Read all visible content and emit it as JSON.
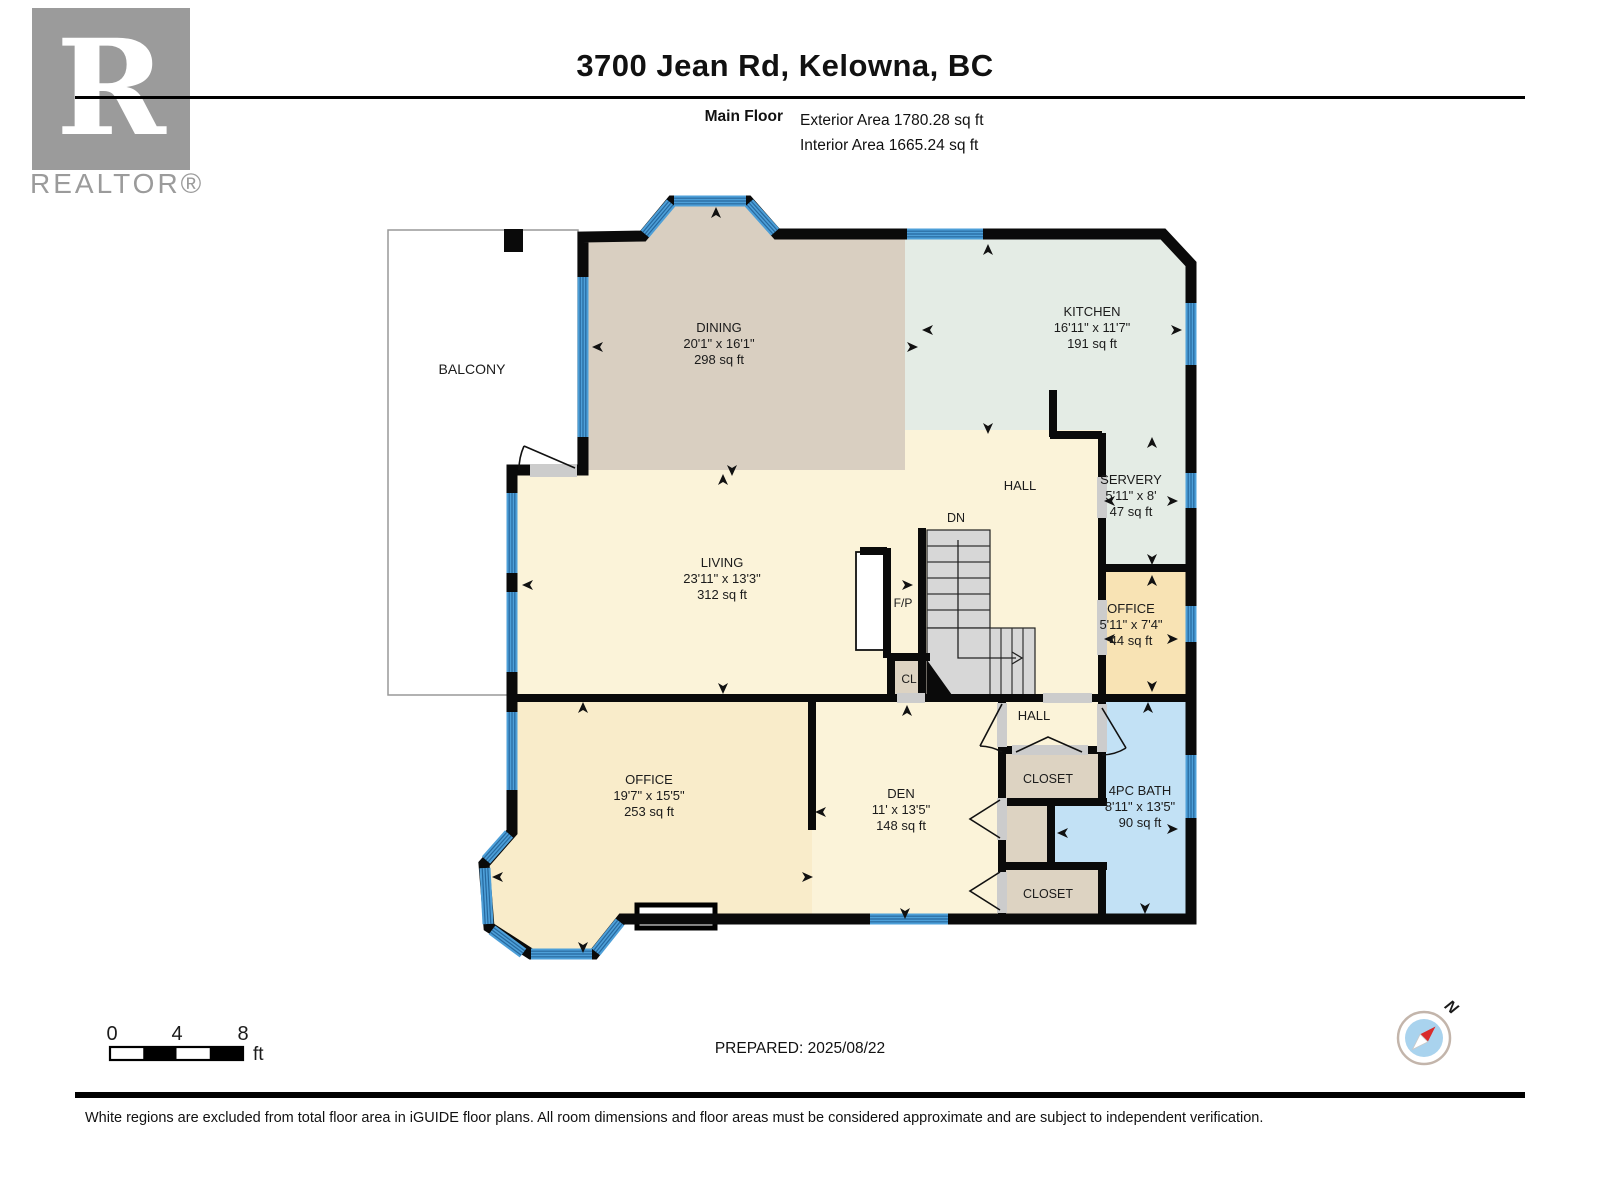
{
  "header": {
    "title": "3700 Jean Rd, Kelowna, BC",
    "floor_label": "Main Floor",
    "exterior_area": "Exterior Area 1780.28 sq ft",
    "interior_area": "Interior Area 1665.24 sq ft"
  },
  "branding": {
    "logo_letter": "R",
    "realtor_text": "REALTOR®"
  },
  "rooms": [
    {
      "id": "balcony",
      "name": "BALCONY",
      "dims": "",
      "area": ""
    },
    {
      "id": "dining",
      "name": "DINING",
      "dims": "20'1\" x 16'1\"",
      "area": "298 sq ft"
    },
    {
      "id": "kitchen",
      "name": "KITCHEN",
      "dims": "16'11\" x 11'7\"",
      "area": "191 sq ft"
    },
    {
      "id": "servery",
      "name": "SERVERY",
      "dims": "5'11\" x 8'",
      "area": "47 sq ft"
    },
    {
      "id": "hall_upper",
      "name": "HALL",
      "dims": "",
      "area": ""
    },
    {
      "id": "dn",
      "name": "DN",
      "dims": "",
      "area": ""
    },
    {
      "id": "living",
      "name": "LIVING",
      "dims": "23'11\" x 13'3\"",
      "area": "312 sq ft"
    },
    {
      "id": "fp",
      "name": "F/P",
      "dims": "",
      "area": ""
    },
    {
      "id": "office_right",
      "name": "OFFICE",
      "dims": "5'11\" x 7'4\"",
      "area": "44 sq ft"
    },
    {
      "id": "cl",
      "name": "CL",
      "dims": "",
      "area": ""
    },
    {
      "id": "hall_lower",
      "name": "HALL",
      "dims": "",
      "area": ""
    },
    {
      "id": "closet_upper",
      "name": "CLOSET",
      "dims": "",
      "area": ""
    },
    {
      "id": "office_main",
      "name": "OFFICE",
      "dims": "19'7\" x 15'5\"",
      "area": "253 sq ft"
    },
    {
      "id": "den",
      "name": "DEN",
      "dims": "11' x 13'5\"",
      "area": "148 sq ft"
    },
    {
      "id": "bath",
      "name": "4PC BATH",
      "dims": "8'11\" x 13'5\"",
      "area": "90 sq ft"
    },
    {
      "id": "closet_lower",
      "name": "CLOSET",
      "dims": "",
      "area": ""
    }
  ],
  "scale_bar": {
    "ticks": [
      "0",
      "4",
      "8"
    ],
    "unit": "ft"
  },
  "prepared": "PREPARED: 2025/08/22",
  "compass": {
    "north_label": "N"
  },
  "footer": {
    "disclaimer": "White regions are excluded from total floor area in iGUIDE floor plans. All room dimensions and floor areas must be considered approximate and are subject to independent verification."
  },
  "colors": {
    "wall": "#0a0a0a",
    "dining": "#d9cfc1",
    "kitchen": "#e4ece5",
    "cream": "#fbf3d9",
    "office_small": "#f8e3b4",
    "office_large": "#f9ecca",
    "closet": "#ddd3c2",
    "bath": "#c2e1f5",
    "window": "#4d9fd8",
    "window_stripe": "#26689e",
    "stair": "#d7d7d7",
    "door_gray": "#cccccc",
    "logo_gray": "#9b9b9b",
    "compass_blue": "#a9d3ee",
    "needle_red": "#d92b2b",
    "balcony_outline": "#999999"
  }
}
